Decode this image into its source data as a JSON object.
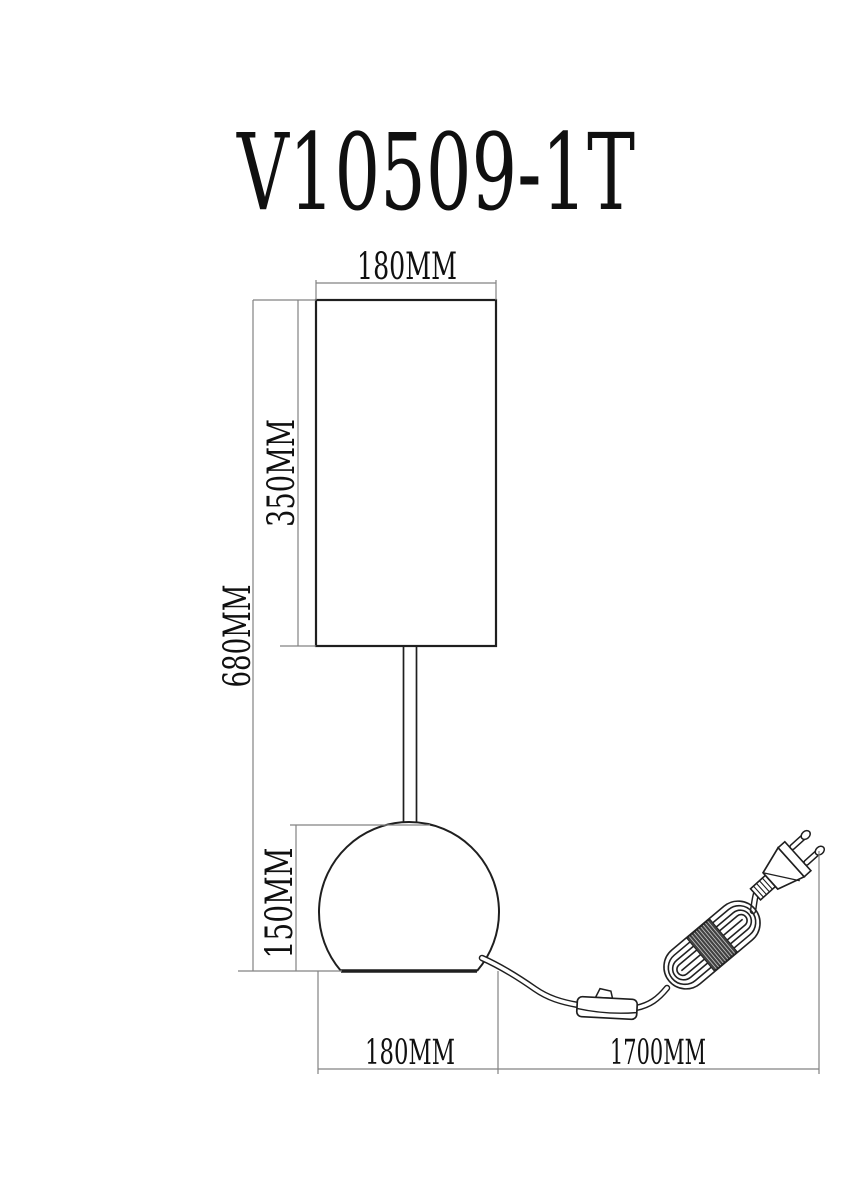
{
  "title": "V10509-1T",
  "colors": {
    "background": "#ffffff",
    "outline": "#1f1f1f",
    "dimension_line": "#828282",
    "label_text": "#101010"
  },
  "labels": {
    "shade_width_top": "180MM",
    "shade_height": "350MM",
    "total_height": "680MM",
    "base_height": "150MM",
    "base_width_bottom": "180MM",
    "cord_length": "1700MM"
  }
}
